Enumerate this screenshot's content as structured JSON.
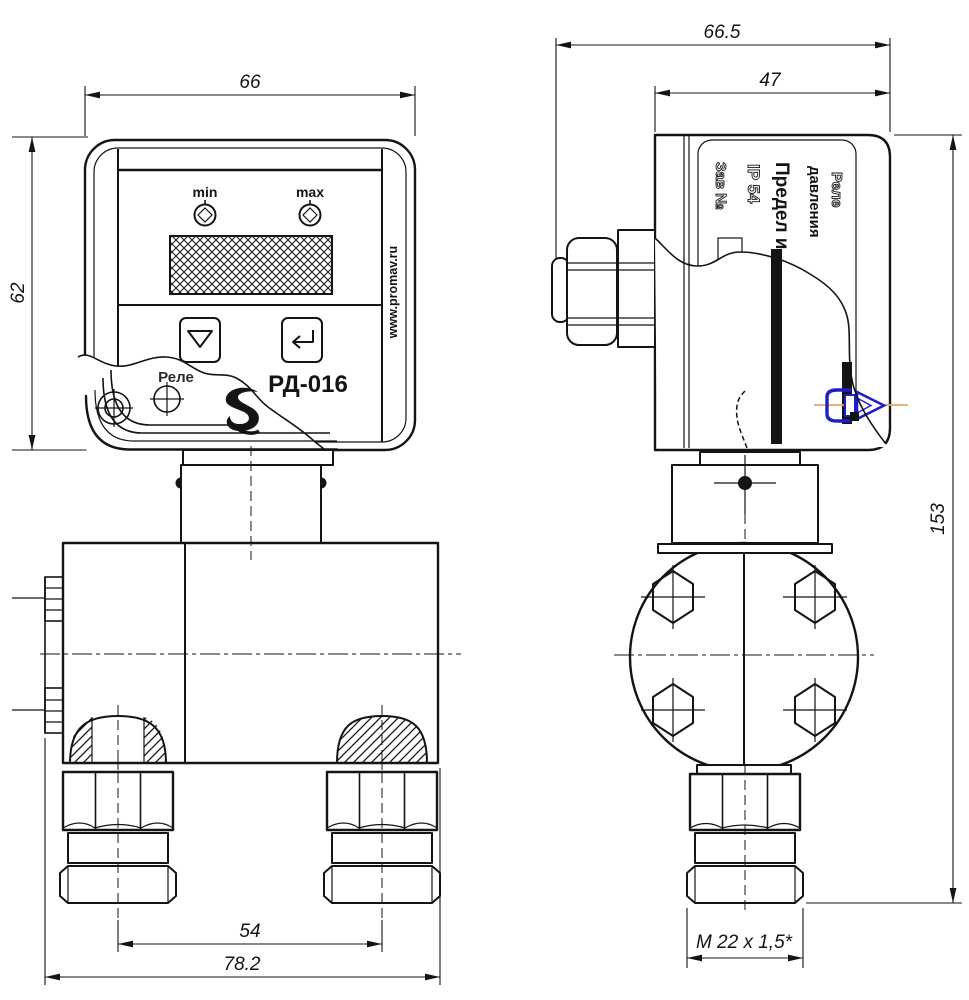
{
  "drawing_title": "РД-016",
  "front_view": {
    "dim_width": "66",
    "dim_height": "62",
    "dim_port_spacing": "54",
    "dim_overall_width": "78.2",
    "panel": {
      "min_label": "min",
      "max_label": "max",
      "model": "РД-016",
      "brand_partial": "Реле",
      "watermark": "www.promav.ru"
    }
  },
  "side_view": {
    "dim_overall_width": "66.5",
    "dim_body_width": "47",
    "dim_height": "153",
    "dim_thread": "M 22 x 1,5*",
    "nameplate": {
      "line1": "Реле",
      "line2": "давления",
      "line3": "Предел и",
      "line4": "IP 54",
      "line5": "Зав №"
    }
  },
  "icons": {
    "down_button": "triangle-down",
    "enter_button": "enter-arrow",
    "min_indicator": "diamond-led",
    "max_indicator": "diamond-led",
    "brand_logo": "script-s-logo",
    "connector_marker": "blue-connector-annotation"
  },
  "colors": {
    "line": "#141414",
    "annotation_blue": "#1e1ec8",
    "centerline_orange": "#e2a96e",
    "background": "#ffffff"
  }
}
